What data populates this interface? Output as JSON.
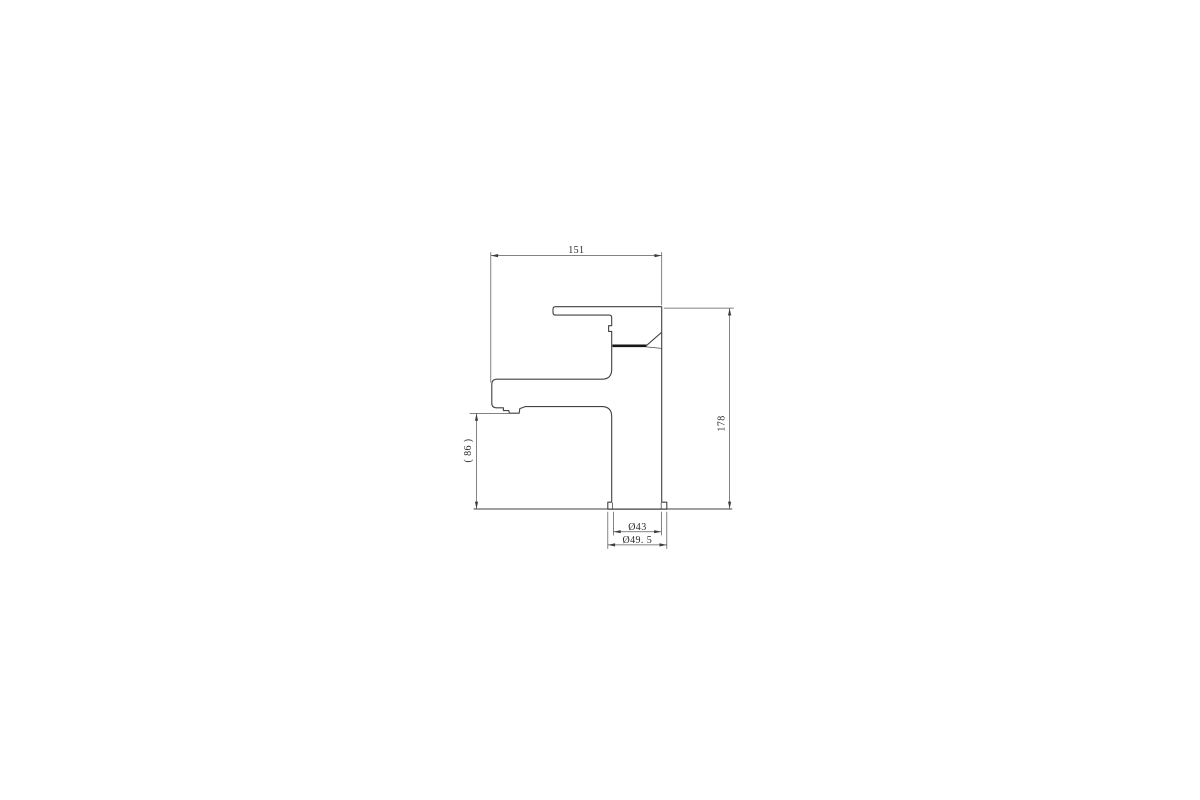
{
  "page": {
    "background_color": "#ffffff"
  },
  "drawing": {
    "subject": "single-lever-basin-mixer-tap-side-elevation",
    "line_color": "#414141",
    "dim_line_color": "#5a5a5a",
    "text_color": "#2b2b2b",
    "labels": {
      "overall_width": "151",
      "overall_height": "178",
      "spout_outlet_height": "( 86 )",
      "body_diameter": "Ø43",
      "base_diameter": "Ø49. 5"
    }
  }
}
